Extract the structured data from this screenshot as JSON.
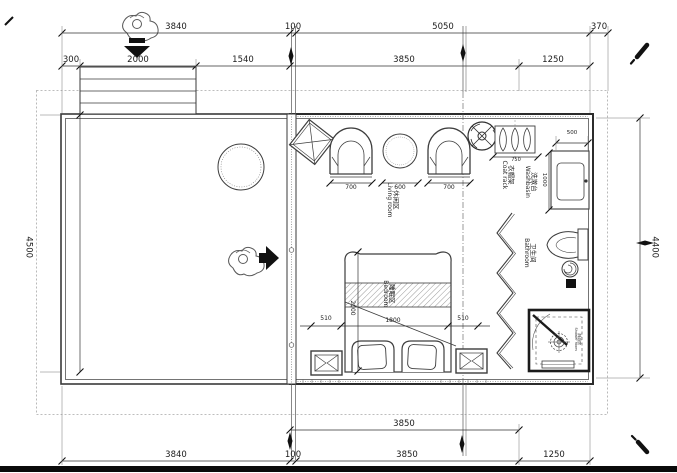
{
  "drawing": {
    "rooms": {
      "living": {
        "cn": "休闲区",
        "en": "Living room"
      },
      "bedroom": {
        "cn": "睡眠区",
        "en": "Bedroom"
      },
      "bathroom": {
        "cn": "卫生间",
        "en": "Bathroom"
      },
      "washbasin": {
        "cn": "洗漱台",
        "en": "Washbasin"
      },
      "coat_rack": {
        "cn": "衣帽架",
        "en": "Coat rack"
      },
      "shower": {
        "cn": "淋浴房",
        "en": "Shower room"
      }
    },
    "dims": {
      "top_row1": [
        "3840",
        "100",
        "5050",
        "370"
      ],
      "top_row2": [
        "300",
        "2000",
        "1540",
        "3850",
        "1250"
      ],
      "bottom_row1": [
        "3850"
      ],
      "bottom_row2": [
        "3840",
        "100",
        "3850",
        "1250"
      ],
      "left_height": "4500",
      "right_height": "4400",
      "chair_widths": [
        "700",
        "600",
        "700"
      ],
      "washbasin_width": "500",
      "washbasin_depth": "1000",
      "coat_rack_width": "750",
      "bed_row": [
        "510",
        "1800",
        "510"
      ],
      "bed_length": "2000"
    },
    "line_color": "#3d3d3d",
    "accent_black": "#111111"
  }
}
